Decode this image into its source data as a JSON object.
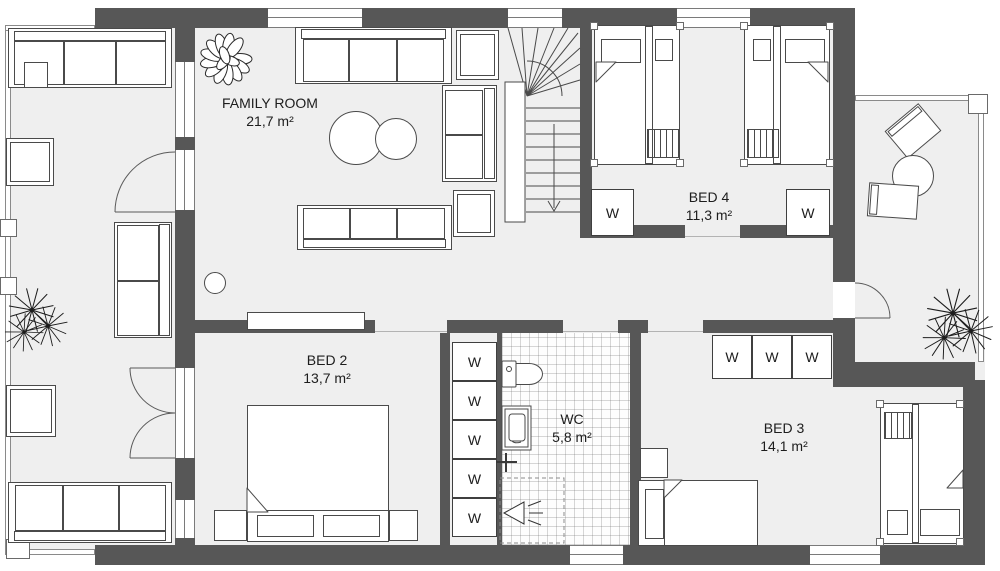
{
  "plan": {
    "rooms": [
      {
        "name": "FAMILY ROOM",
        "area": "21,7 m²"
      },
      {
        "name": "BED 4",
        "area": "11,3 m²"
      },
      {
        "name": "BED 2",
        "area": "13,7 m²"
      },
      {
        "name": "WC",
        "area": "5,8 m²"
      },
      {
        "name": "BED 3",
        "area": "14,1 m²"
      }
    ],
    "wardrobes": {
      "bed4": [
        "W",
        "W"
      ],
      "hall_closet": [
        "W",
        "W",
        "W",
        "W",
        "W"
      ],
      "bed3": [
        "W",
        "W",
        "W"
      ]
    },
    "stairs": {
      "direction": "down"
    },
    "colors": {
      "wall": "#575757",
      "floor": "#efefef",
      "outline": "#4a4a4a",
      "tile_grid": "#6e6e6e"
    }
  }
}
